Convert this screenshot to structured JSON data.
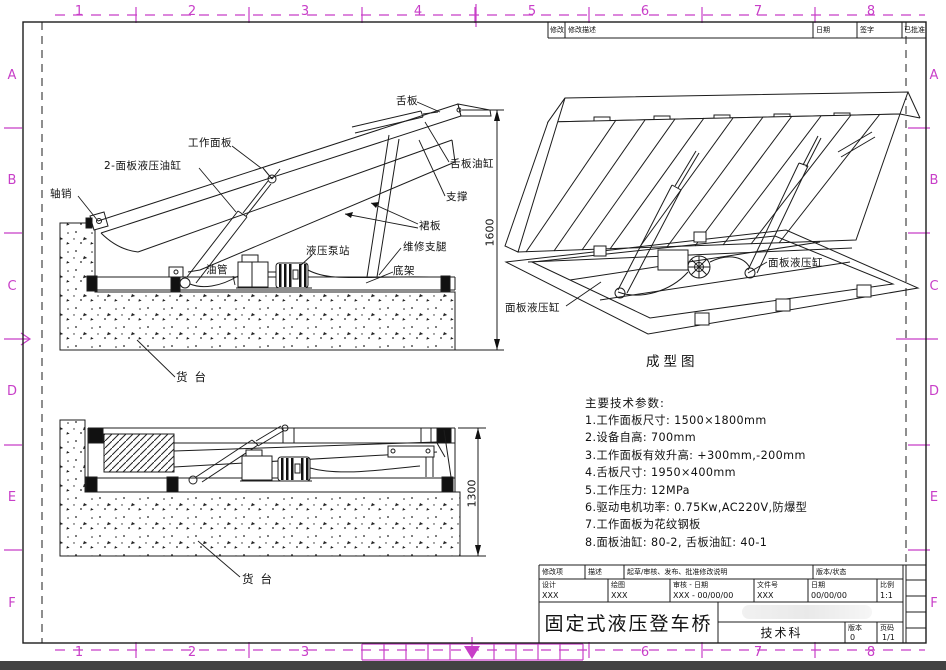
{
  "page": {
    "bg": "#ffffff",
    "line_color": "#1c1c1c",
    "zone_color": "#c83ec8",
    "bottom_bar_color": "#424242"
  },
  "zones": {
    "top": [
      "1",
      "2",
      "3",
      "4",
      "5",
      "6",
      "7",
      "8"
    ],
    "bottom": [
      "1",
      "2",
      "3",
      "6",
      "7",
      "8"
    ],
    "left": [
      "A",
      "B",
      "C",
      "D",
      "E",
      "F"
    ],
    "right": [
      "A",
      "B",
      "C",
      "D",
      "E",
      "F"
    ]
  },
  "revision_strip": {
    "col_mod": "修改",
    "col_desc": "修改描述",
    "col_date": "日期",
    "col_sign": "签字",
    "col_approved": "已批准"
  },
  "view_side_raised": {
    "labels": {
      "axle_pin": "轴销",
      "panel_cylinder": "2-面板液压油缸",
      "work_panel": "工作面板",
      "lip_plate": "舌板",
      "lip_cylinder": "舌板油缸",
      "support": "支撑",
      "skirt": "裙板",
      "maintenance_leg": "维修支腿",
      "pump_station": "液压泵站",
      "oil_pipe": "油管",
      "base_frame": "底架",
      "dock": "货台"
    },
    "dimension": "1600"
  },
  "view_isometric": {
    "label_left": "面板液压缸",
    "label_right": "面板液压缸",
    "caption": "成型图"
  },
  "view_side_stored": {
    "dock": "货台",
    "dimension": "1300"
  },
  "specs": {
    "title": "主要技术参数:",
    "items": [
      "1.工作面板尺寸: 1500×1800mm",
      "2.设备自高: 700mm",
      "3.工作面板有效升高: +300mm,-200mm",
      "4.舌板尺寸: 1950×400mm",
      "5.工作压力: 12MPa",
      "6.驱动电机功率: 0.75Kw,AC220V,防爆型",
      "7.工作面板为花纹钢板",
      "8.面板油缸: 80-2, 舌板油缸: 40-1"
    ]
  },
  "title_block": {
    "rev_item_label": "修改项",
    "desc_label": "描述",
    "approval_label": "起草/审核、发布、批准修改说明",
    "version_state_label": "版本/状态",
    "design_label": "设计",
    "design_value": "XXX",
    "draft_label": "绘图",
    "draft_value": "XXX",
    "check_label": "审核 - 日期",
    "check_value": "XXX - 00/00/00",
    "file_label": "文件号",
    "file_value": "XXX",
    "date_label": "日期",
    "date_value": "00/00/00",
    "scale_label": "比例",
    "scale_value": "1:1",
    "title": "固定式液压登车桥",
    "department": "技术科",
    "version_label": "版本",
    "version_value": "0",
    "sheet_label": "页码",
    "sheet_value": "1/1"
  }
}
